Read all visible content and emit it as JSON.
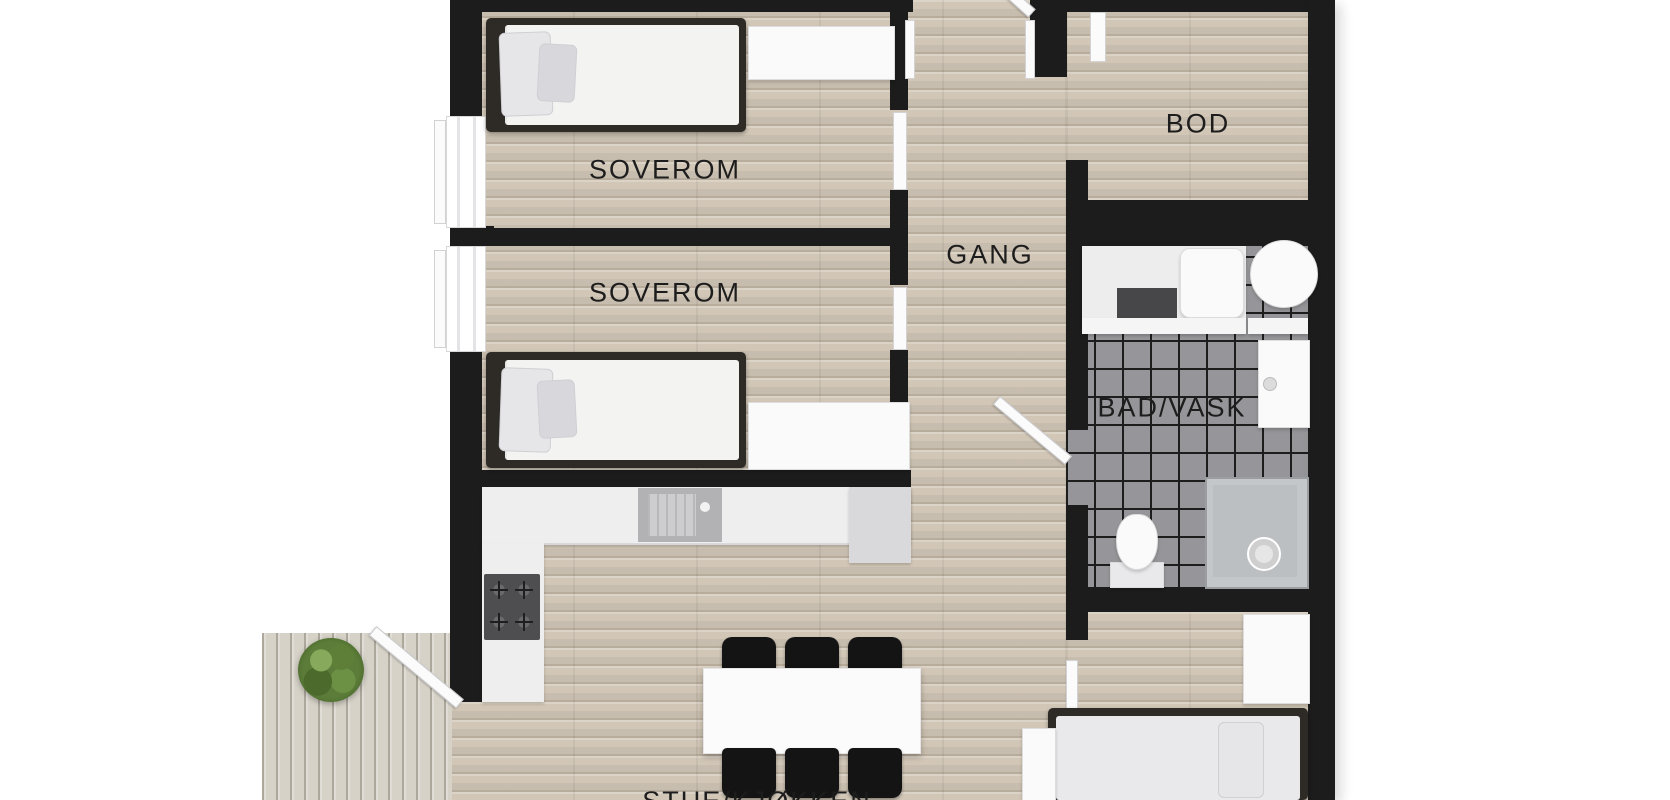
{
  "rooms": {
    "bedroom1": {
      "label": "SOVEROM"
    },
    "bedroom2": {
      "label": "SOVEROM"
    },
    "hallway": {
      "label": "GANG"
    },
    "storage": {
      "label": "BOD"
    },
    "bathroom": {
      "label": "BAD/VASK"
    },
    "living_kitchen": {
      "label": "STUE/KJØKKEN"
    }
  },
  "colors": {
    "wall": "#1c1c1c",
    "wood_floor": "#d2c7b7",
    "deck_floor": "#d6d2c8",
    "tile_floor": "#96969a",
    "label_text": "#1d1d1d",
    "furniture_white": "#f3f3f2",
    "bed_frame": "#2e2a26",
    "chair_black": "#141414",
    "plant_green": "#5c7d39"
  }
}
